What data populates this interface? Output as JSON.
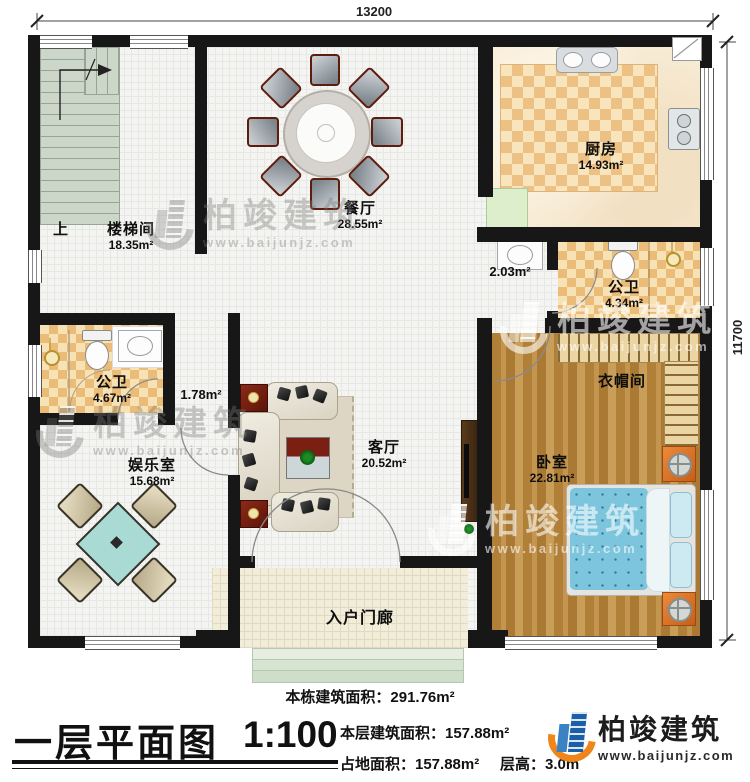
{
  "dimensions": {
    "width_label": "13200",
    "height_label": "11700"
  },
  "rooms": {
    "stairwell": {
      "name": "楼梯间",
      "area": "18.35m²"
    },
    "up": "上",
    "dining": {
      "name": "餐厅",
      "area": "28.55m²"
    },
    "kitchen": {
      "name": "厨房",
      "area": "14.93m²"
    },
    "bath_top": {
      "name": "公卫",
      "area": "4.34m²"
    },
    "cloakroom": {
      "name": "衣帽间"
    },
    "bedroom": {
      "name": "卧室",
      "area": "22.81m²"
    },
    "bath_left": {
      "name": "公卫",
      "area": "4.67m²"
    },
    "entertainment": {
      "name": "娱乐室",
      "area": "15.68m²"
    },
    "living": {
      "name": "客厅",
      "area": "20.52m²"
    },
    "porch": {
      "name": "入户门廊"
    },
    "corridor_area": "2.03m²",
    "vestibule_area": "1.78m²"
  },
  "footer": {
    "building_total": "本栋建筑面积：291.76m²",
    "title": "一层平面图",
    "scale": "1:100",
    "floor_area": "本层建筑面积：157.88m²",
    "land_area": "占地面积：157.88m²",
    "floor_height": "层高：3.0m"
  },
  "brand": {
    "name": "柏竣建筑",
    "url": "www.baijunjz.com",
    "blue": "#1a5fa8",
    "orange": "#f08519"
  },
  "watermark": {
    "name": "柏竣建筑",
    "url": "www.baijunjz.com"
  }
}
